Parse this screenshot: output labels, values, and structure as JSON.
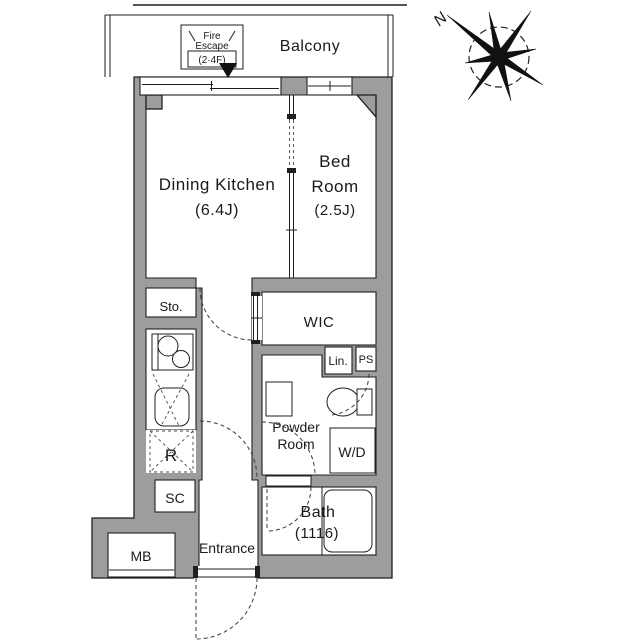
{
  "plan": {
    "balcony_label": "Balcony",
    "fire_escape": {
      "line1": "Fire",
      "line2": "Escape",
      "floors": "(2·4F)"
    },
    "compass": {
      "north": "N"
    },
    "rooms": {
      "dining_kitchen": {
        "name": "Dining Kitchen",
        "size": "(6.4J)"
      },
      "bed_room": {
        "line1": "Bed",
        "line2": "Room",
        "size": "(2.5J)"
      },
      "storage": "Sto.",
      "wic": "WIC",
      "linen": "Lin.",
      "pipe_space": "PS",
      "powder_room": {
        "line1": "Powder",
        "line2": "Room"
      },
      "washer_dryer": "W/D",
      "refrigerator": "R",
      "shoe_closet": "SC",
      "meter_box": "MB",
      "entrance": "Entrance",
      "bath": {
        "name": "Bath",
        "size": "(1116)"
      }
    },
    "colors": {
      "wall": "#9d9d9d",
      "outline": "#1f1f1f",
      "background": "#ffffff"
    }
  }
}
